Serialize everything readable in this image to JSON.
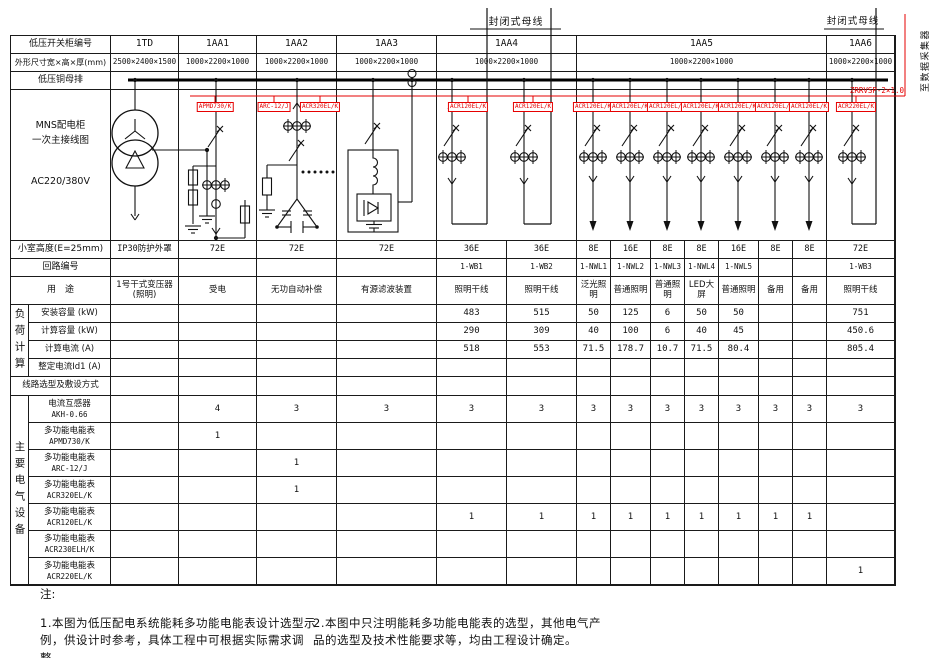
{
  "colors": {
    "red": "#e60000",
    "line": "#1a1a1a"
  },
  "top": {
    "busway_left": "封闭式母线",
    "busway_right": "封闭式母线",
    "to_collector": "至数据采集器",
    "cable_tag": "ZRRVSP-2×1.0"
  },
  "table": {
    "row_labels": {
      "cabinet_no": "低压开关柜编号",
      "dimensions": "外形尺寸宽×高×厚(mm)",
      "busbar": "低压铜母排",
      "schematic": [
        "MNS配电柜",
        "一次主接线图",
        "AC220/380V"
      ],
      "chamber": "小室高度(E=25mm)",
      "circuit": "回路编号",
      "purpose": "用　途",
      "load_section": "负荷计算",
      "line_select": "线路选型及敷设方式",
      "equip_section": "主要电气设备"
    },
    "cabinets": [
      {
        "id": "1TD",
        "dim": "2500×2400×1500",
        "span": 1
      },
      {
        "id": "1AA1",
        "dim": "1000×2200×1000",
        "span": 1
      },
      {
        "id": "1AA2",
        "dim": "1000×2200×1000",
        "span": 1
      },
      {
        "id": "1AA3",
        "dim": "1000×2200×1000",
        "span": 1
      },
      {
        "id": "1AA4",
        "dim": "1000×2200×1000",
        "span": 2
      },
      {
        "id": "1AA5",
        "dim": "1000×2200×1000",
        "span": 7
      },
      {
        "id": "1AA6",
        "dim": "1000×2200×1000",
        "span": 1
      }
    ],
    "chamber_values": [
      "IP30防护外罩",
      "72E",
      "72E",
      "72E",
      "36E",
      "36E",
      "8E",
      "16E",
      "8E",
      "8E",
      "16E",
      "8E",
      "8E",
      "72E"
    ],
    "circuit_values": [
      "",
      "",
      "",
      "",
      "1-WB1",
      "1-WB2",
      "1-NWL1",
      "1-NWL2",
      "1-NWL3",
      "1-NWL4",
      "1-NWL5",
      "",
      "",
      "1-WB3"
    ],
    "purpose_values": [
      "1号干式变压器(照明)",
      "受电",
      "无功自动补偿",
      "有源滤波装置",
      "照明干线",
      "照明干线",
      "泛光照明",
      "普通照明",
      "普通照明",
      "LED大屏",
      "普通照明",
      "备用",
      "备用",
      "照明干线"
    ],
    "load_rows": [
      {
        "label": "安装容量 (kW)",
        "values": [
          "",
          "",
          "",
          "",
          "483",
          "515",
          "50",
          "125",
          "6",
          "50",
          "50",
          "",
          "",
          "751"
        ]
      },
      {
        "label": "计算容量 (kW)",
        "values": [
          "",
          "",
          "",
          "",
          "290",
          "309",
          "40",
          "100",
          "6",
          "40",
          "45",
          "",
          "",
          "450.6"
        ]
      },
      {
        "label": "计算电流 (A)",
        "values": [
          "",
          "",
          "",
          "",
          "518",
          "553",
          "71.5",
          "178.7",
          "10.7",
          "71.5",
          "80.4",
          "",
          "",
          "805.4"
        ]
      },
      {
        "label": "整定电流Id1 (A)",
        "values": [
          "",
          "",
          "",
          "",
          "",
          "",
          "",
          "",
          "",
          "",
          "",
          "",
          "",
          ""
        ]
      }
    ],
    "equip_rows": [
      {
        "name": "电流互感器",
        "model": "AKH-0.66",
        "values": [
          "",
          "4",
          "3",
          "3",
          "3",
          "3",
          "3",
          "3",
          "3",
          "3",
          "3",
          "3",
          "3",
          "3"
        ]
      },
      {
        "name": "多功能电能表",
        "model": "APMD730/K",
        "values": [
          "",
          "1",
          "",
          "",
          "",
          "",
          "",
          "",
          "",
          "",
          "",
          "",
          "",
          ""
        ]
      },
      {
        "name": "多功能电能表",
        "model": "ARC-12/J",
        "values": [
          "",
          "",
          "1",
          "",
          "",
          "",
          "",
          "",
          "",
          "",
          "",
          "",
          "",
          ""
        ]
      },
      {
        "name": "多功能电能表",
        "model": "ACR320EL/K",
        "values": [
          "",
          "",
          "1",
          "",
          "",
          "",
          "",
          "",
          "",
          "",
          "",
          "",
          "",
          ""
        ]
      },
      {
        "name": "多功能电能表",
        "model": "ACR120EL/K",
        "values": [
          "",
          "",
          "",
          "",
          "1",
          "1",
          "1",
          "1",
          "1",
          "1",
          "1",
          "1",
          "1",
          ""
        ]
      },
      {
        "name": "多功能电能表",
        "model": "ACR230ELH/K",
        "values": [
          "",
          "",
          "",
          "",
          "",
          "",
          "",
          "",
          "",
          "",
          "",
          "",
          "",
          ""
        ]
      },
      {
        "name": "多功能电能表",
        "model": "ACR220EL/K",
        "values": [
          "",
          "",
          "",
          "",
          "",
          "",
          "",
          "",
          "",
          "",
          "",
          "",
          "",
          "1"
        ]
      }
    ]
  },
  "schematic_meters": [
    "APMD730/K",
    "ARC-12/J",
    "ACR320EL/K",
    "ACR120EL/K",
    "ACR120EL/K",
    "ACR120EL/K",
    "ACR120EL/K",
    "ACR120EL/K",
    "ACR120EL/K",
    "ACR120EL/K",
    "ACR120EL/K",
    "ACR120EL/K",
    "ACR220EL/K"
  ],
  "notes": {
    "heading": "注:",
    "items": [
      "1.本图为低压配电系统能耗多功能电能表设计选型示例，供设计时参考，具体工程中可根据实际需求调整。",
      "2.本图中只注明能耗多功能电能表的选型，其他电气产品的选型及技术性能要求等，均由工程设计确定。"
    ]
  }
}
